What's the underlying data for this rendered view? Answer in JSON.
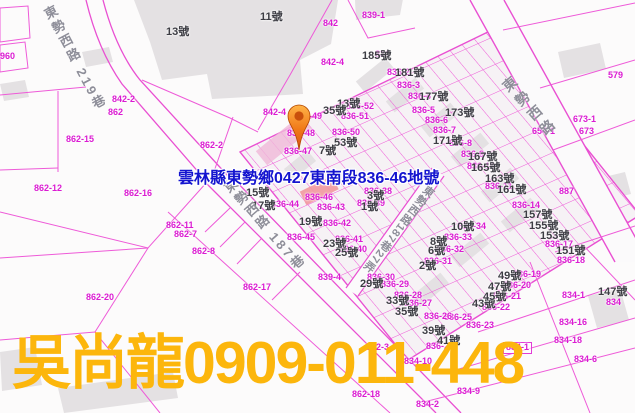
{
  "overlay": {
    "address": "雲林縣東勢鄉0427東南段836-46地號",
    "contact": "吳尚龍0909-011-448"
  },
  "marker": {
    "icon": "location-pin-icon",
    "points_to_parcel": "836-46"
  },
  "colors": {
    "parcel_line_pink": "#ee5ad8",
    "parcel_label_magenta": "#db1bd2",
    "house_number_gray": "#3d3d44",
    "road_label_gray": "#8e8e99",
    "address_blue": "#1414cf",
    "watermark_gold": "#fcb60c",
    "marker_orange": "#f07818",
    "highlight_parcel_fill": "#f2989e",
    "building_gray": "#e4e1e3"
  },
  "road_labels": [
    {
      "text": "東勢西路 219巷",
      "x": 44,
      "y": 5,
      "rot": -28,
      "size": 13,
      "ls": 3
    },
    {
      "text": "東勢西路 187巷",
      "x": 224,
      "y": 178,
      "rot": -41,
      "size": 13,
      "ls": 3
    },
    {
      "text": "東勢西路187巷27弄",
      "x": 420,
      "y": 186,
      "rot": 38,
      "size": 11,
      "ls": 1
    },
    {
      "text": "東勢西路",
      "x": 503,
      "y": 76,
      "rot": -41,
      "size": 14,
      "ls": 5
    }
  ],
  "parcel_labels": [
    [
      "960",
      0,
      52
    ],
    [
      "842-2",
      112,
      95
    ],
    [
      "862",
      108,
      108
    ],
    [
      "862-15",
      66,
      135
    ],
    [
      "862-2",
      200,
      141
    ],
    [
      "862-12",
      34,
      184
    ],
    [
      "862-16",
      124,
      189
    ],
    [
      "862-11",
      166,
      221
    ],
    [
      "862-7",
      174,
      230
    ],
    [
      "862-8",
      192,
      247
    ],
    [
      "862-17",
      243,
      283
    ],
    [
      "862-20",
      86,
      293
    ],
    [
      "862-3",
      366,
      343
    ],
    [
      "862-18",
      352,
      390
    ],
    [
      "839-1",
      362,
      11
    ],
    [
      "842",
      323,
      19
    ],
    [
      "842-4",
      321,
      58
    ],
    [
      "836",
      375,
      50
    ],
    [
      "836-2",
      387,
      68
    ],
    [
      "836-3",
      397,
      81
    ],
    [
      "836-4",
      408,
      92
    ],
    [
      "836-5",
      412,
      106
    ],
    [
      "836-6",
      425,
      116
    ],
    [
      "836-7",
      433,
      126
    ],
    [
      "836-8",
      449,
      139
    ],
    [
      "836-9",
      461,
      150
    ],
    [
      "836-10",
      467,
      162
    ],
    [
      "836-11",
      485,
      182
    ],
    [
      "836-14",
      512,
      201
    ],
    [
      "836-17",
      545,
      240
    ],
    [
      "836-18",
      557,
      256
    ],
    [
      "579",
      608,
      71
    ],
    [
      "673-1",
      573,
      115
    ],
    [
      "673",
      579,
      127
    ],
    [
      "654-1",
      532,
      127
    ],
    [
      "887",
      559,
      187
    ],
    [
      "834-1",
      562,
      291
    ],
    [
      "834",
      606,
      298
    ],
    [
      "834-16",
      559,
      318
    ],
    [
      "834-18",
      554,
      336
    ],
    [
      "834-1",
      503,
      342,
      1
    ],
    [
      "834-9",
      457,
      387
    ],
    [
      "834-2",
      416,
      400
    ],
    [
      "834-10",
      404,
      357
    ],
    [
      "834-6",
      574,
      355
    ],
    [
      "836-19",
      513,
      270
    ],
    [
      "836-20",
      503,
      281
    ],
    [
      "836-21",
      493,
      292
    ],
    [
      "836-22",
      482,
      303
    ],
    [
      "836-23",
      466,
      321
    ],
    [
      "836-25",
      444,
      313
    ],
    [
      "836-26",
      424,
      312
    ],
    [
      "836-27",
      404,
      299
    ],
    [
      "836-28",
      394,
      291
    ],
    [
      "836-29",
      381,
      280
    ],
    [
      "836-30",
      367,
      273
    ],
    [
      "836-31",
      424,
      257
    ],
    [
      "836-32",
      436,
      245
    ],
    [
      "836-33",
      444,
      233
    ],
    [
      "836-34",
      458,
      222
    ],
    [
      "836-38",
      364,
      187
    ],
    [
      "836-39",
      357,
      199
    ],
    [
      "836-40",
      339,
      245
    ],
    [
      "836-41",
      335,
      235
    ],
    [
      "836-42",
      323,
      219
    ],
    [
      "836-43",
      317,
      203
    ],
    [
      "836-44",
      271,
      200
    ],
    [
      "836-45",
      287,
      233
    ],
    [
      "836-46",
      305,
      193
    ],
    [
      "836-47",
      284,
      147
    ],
    [
      "836-48",
      287,
      129
    ],
    [
      "836-49",
      294,
      112
    ],
    [
      "842-4",
      263,
      108
    ],
    [
      "836-50",
      332,
      128
    ],
    [
      "836-51",
      341,
      112
    ],
    [
      "836-52",
      346,
      102
    ],
    [
      "836-24",
      426,
      342
    ],
    [
      "839-4",
      318,
      273
    ]
  ],
  "house_labels": [
    [
      "13號",
      166,
      27
    ],
    [
      "11號",
      260,
      12
    ],
    [
      "185號",
      362,
      51
    ],
    [
      "181號",
      395,
      68
    ],
    [
      "177號",
      419,
      92
    ],
    [
      "173號",
      445,
      108
    ],
    [
      "171號",
      433,
      136
    ],
    [
      "167號",
      468,
      152
    ],
    [
      "165號",
      471,
      163
    ],
    [
      "163號",
      485,
      174
    ],
    [
      "161號",
      497,
      185
    ],
    [
      "157號",
      523,
      210
    ],
    [
      "155號",
      529,
      221
    ],
    [
      "153號",
      540,
      231
    ],
    [
      "151號",
      556,
      246
    ],
    [
      "147號",
      598,
      287
    ],
    [
      "15號",
      246,
      188
    ],
    [
      "17號",
      252,
      201
    ],
    [
      "19號",
      299,
      217
    ],
    [
      "23號",
      323,
      239
    ],
    [
      "25號",
      335,
      248
    ],
    [
      "1號",
      361,
      202
    ],
    [
      "3號",
      367,
      191
    ],
    [
      "13號",
      337,
      99
    ],
    [
      "35號",
      323,
      106
    ],
    [
      "53號",
      334,
      138
    ],
    [
      "7號",
      319,
      146
    ],
    [
      "2號",
      419,
      261
    ],
    [
      "6號",
      428,
      246
    ],
    [
      "8號",
      430,
      237
    ],
    [
      "10號",
      451,
      222
    ],
    [
      "29號",
      360,
      279
    ],
    [
      "33號",
      386,
      296
    ],
    [
      "35號",
      395,
      307
    ],
    [
      "39號",
      422,
      326
    ],
    [
      "41號",
      437,
      336
    ],
    [
      "43號",
      472,
      299
    ],
    [
      "45號",
      483,
      292
    ],
    [
      "47號",
      488,
      282
    ],
    [
      "49號",
      498,
      271
    ]
  ]
}
